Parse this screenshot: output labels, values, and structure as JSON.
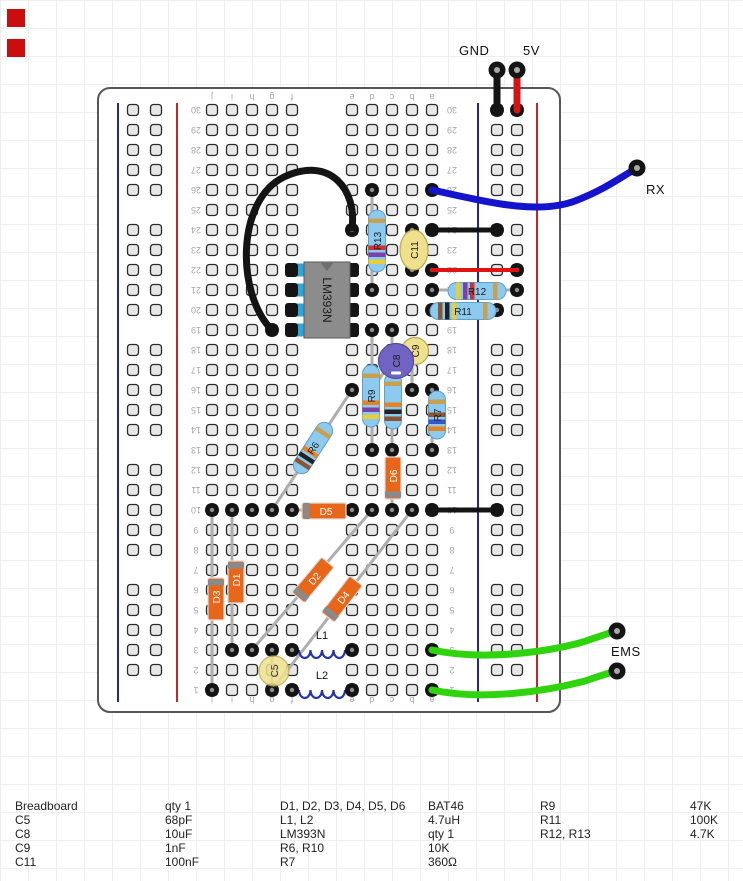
{
  "labels": {
    "gnd": "GND",
    "v5": "5V",
    "rx": "RX",
    "ems": "EMS"
  },
  "markers": [
    {
      "x": 7,
      "y": 9
    },
    {
      "x": 7,
      "y": 39
    }
  ],
  "palette": {
    "marker_red": "#cc0d0d",
    "black": "#141414",
    "red": "#d41414",
    "red2": "#e01212",
    "blue": "#1414cc",
    "green": "#2fd40f",
    "lead": "#aeaeae",
    "hole_fill": "#e7e7e7",
    "hole_stroke": "#2a2a2a",
    "board_fill": "#ffffff",
    "board_stroke": "#575757",
    "rail_blue": "#2626a0",
    "rail_red": "#c62828",
    "resistor": "#8dcaf0",
    "resistor_stroke": "#5f9fc8",
    "diode": "#e8661a",
    "diode_stroke": "#dcdcdc",
    "diode_band": "#8a8a8a",
    "diode_label": "#ffffff",
    "ic": "#8c8c8c",
    "ic_stroke": "#5a5a5a",
    "ic_notch": "#6e6e6e",
    "pin_cyan": "#2aa8dc",
    "cap_yellow": "#efe08d",
    "cap_yellow_stroke": "#b9a94e",
    "cap_purple": "#6f64c4",
    "cap_purple_stroke": "#564a9e",
    "coil": "#2333aa",
    "num": "#a6a6a6",
    "ring_center": "#8f8f8f",
    "label_dark": "#1c1c1c"
  },
  "board": {
    "x": 98,
    "y": 88,
    "w": 462,
    "h": 624,
    "radius": 12,
    "cols": {
      "j": 212,
      "i": 232,
      "h": 252,
      "g": 272,
      "f": 292,
      "e": 352,
      "d": 372,
      "c": 392,
      "b": 412,
      "a": 432
    },
    "row_base_y": 110,
    "row_pitch": 20,
    "row_count": 30,
    "left_letters": [
      "j",
      "i",
      "h",
      "g",
      "f"
    ],
    "right_letters": [
      "e",
      "d",
      "c",
      "b",
      "a"
    ],
    "num_x": [
      196,
      452
    ],
    "letters_y": [
      97,
      700
    ],
    "rails": {
      "left": {
        "blue_x": 118,
        "red_x": 177,
        "holes_x": [
          133,
          156
        ]
      },
      "right": {
        "blue_x": 478,
        "red_x": 537,
        "holes_x": [
          497,
          517
        ]
      }
    },
    "rail_y0": 110,
    "rail_groups": 5,
    "rail_group_pitch": 120,
    "rail_hole_pitch": 20,
    "rail_line_y": [
      103,
      702
    ]
  },
  "rings_grid": [
    [
      "d",
      26
    ],
    [
      "a",
      26
    ],
    [
      "e",
      24
    ],
    [
      "b",
      24
    ],
    [
      "a",
      24
    ],
    [
      "b",
      22
    ],
    [
      "a",
      22
    ],
    [
      "d",
      21
    ],
    [
      "a",
      21
    ],
    [
      "a",
      20
    ],
    [
      "g",
      19
    ],
    [
      "d",
      19
    ],
    [
      "c",
      19
    ],
    [
      "e",
      16
    ],
    [
      "d",
      16
    ],
    [
      "c",
      16
    ],
    [
      "b",
      16
    ],
    [
      "a",
      16
    ],
    [
      "d",
      13
    ],
    [
      "c",
      13
    ],
    [
      "a",
      13
    ],
    [
      "j",
      10
    ],
    [
      "i",
      10
    ],
    [
      "h",
      10
    ],
    [
      "g",
      10
    ],
    [
      "f",
      10
    ],
    [
      "e",
      10
    ],
    [
      "d",
      10
    ],
    [
      "c",
      10
    ],
    [
      "b",
      10
    ],
    [
      "a",
      10
    ],
    [
      "i",
      3
    ],
    [
      "h",
      3
    ],
    [
      "g",
      3
    ],
    [
      "f",
      3
    ],
    [
      "e",
      3
    ],
    [
      "a",
      3
    ],
    [
      "j",
      1
    ],
    [
      "g",
      1
    ],
    [
      "f",
      1
    ],
    [
      "e",
      1
    ],
    [
      "a",
      1
    ]
  ],
  "rings_abs": [
    [
      497,
      110
    ],
    [
      517,
      110
    ],
    [
      497,
      230
    ],
    [
      517,
      270
    ],
    [
      517,
      290
    ],
    [
      497,
      310
    ],
    [
      497,
      510
    ]
  ],
  "leads": [
    [
      372,
      190,
      372,
      290
    ],
    [
      372,
      330,
      372,
      450
    ],
    [
      392,
      330,
      392,
      450
    ],
    [
      432,
      390,
      432,
      450
    ],
    [
      412,
      230,
      412,
      270
    ],
    [
      412,
      350,
      412,
      390
    ],
    [
      388,
      366,
      372,
      390
    ],
    [
      397,
      368,
      392,
      390
    ],
    [
      272,
      650,
      272,
      690
    ],
    [
      212,
      510,
      212,
      690
    ],
    [
      232,
      510,
      232,
      650
    ],
    [
      392,
      450,
      392,
      510
    ],
    [
      292,
      510,
      352,
      510
    ],
    [
      252,
      650,
      372,
      510
    ],
    [
      272,
      690,
      412,
      510
    ],
    [
      272,
      510,
      352,
      390
    ],
    [
      432,
      290,
      517,
      290
    ],
    [
      432,
      310,
      497,
      310
    ]
  ],
  "band_sets": {
    "4.7K": [
      "#e8cf3a",
      "#7d3fa8",
      "#d03030",
      "#c8a050"
    ],
    "47K": [
      "#e8cf3a",
      "#7d3fa8",
      "#e8821e",
      "#c8a050"
    ],
    "100K": [
      "#8a5632",
      "#222222",
      "#e8cf3a",
      "#c8a050"
    ],
    "10K": [
      "#8a5632",
      "#222222",
      "#e8821e",
      "#c8a050"
    ],
    "360": [
      "#e8821e",
      "#3a55c8",
      "#8a5632",
      "#c8a050"
    ]
  },
  "resistors": [
    {
      "name": "R13",
      "label": "R13",
      "cx": 377,
      "cy": 241,
      "len": 62,
      "angle": -90,
      "bands": "4.7K"
    },
    {
      "name": "R9",
      "label": "R9",
      "cx": 371,
      "cy": 396,
      "len": 62,
      "angle": -90,
      "bands": "47K"
    },
    {
      "name": "R10",
      "label": "",
      "cx": 393,
      "cy": 401,
      "len": 56,
      "angle": -90,
      "bands": "10K"
    },
    {
      "name": "R7",
      "label": "R7",
      "cx": 437,
      "cy": 415,
      "len": 48,
      "angle": -90,
      "bands": "360"
    },
    {
      "name": "R6",
      "label": "R6",
      "cx": 313,
      "cy": 448,
      "len": 58,
      "angle": -57,
      "bands": "10K"
    },
    {
      "name": "R12",
      "label": "R12",
      "cx": 477,
      "cy": 291,
      "len": 58,
      "angle": 0,
      "bands": "4.7K"
    },
    {
      "name": "R11",
      "label": "R11",
      "cx": 463,
      "cy": 311,
      "len": 66,
      "angle": 0,
      "bands": "100K"
    }
  ],
  "diodes": [
    {
      "name": "D5",
      "label": "D5",
      "cx": 324,
      "cy": 511,
      "len": 44,
      "angle": 0,
      "band": "minus"
    },
    {
      "name": "D6",
      "label": "D6",
      "cx": 393,
      "cy": 478,
      "len": 42,
      "angle": -90,
      "band": "minus"
    },
    {
      "name": "D3",
      "label": "D3",
      "cx": 216,
      "cy": 599,
      "len": 42,
      "angle": -90,
      "band": "plus"
    },
    {
      "name": "D1",
      "label": "D1",
      "cx": 236,
      "cy": 582,
      "len": 42,
      "angle": -90,
      "band": "plus"
    },
    {
      "name": "D2",
      "label": "D2",
      "cx": 313,
      "cy": 580,
      "len": 46,
      "angle": -50,
      "band": "minus"
    },
    {
      "name": "D4",
      "label": "D4",
      "cx": 342,
      "cy": 599,
      "len": 46,
      "angle": -52,
      "band": "minus"
    }
  ],
  "capacitors": [
    {
      "name": "C9",
      "label": "C9",
      "cx": 415,
      "cy": 351,
      "rx": 13.5,
      "ry": 13.5,
      "style": "yellow"
    },
    {
      "name": "C8",
      "label": "C8",
      "cx": 396,
      "cy": 361,
      "rx": 17.5,
      "ry": 17.5,
      "style": "purple",
      "polarity": true
    },
    {
      "name": "C11",
      "label": "C11",
      "cx": 414,
      "cy": 250,
      "rx": 14,
      "ry": 20,
      "style": "yellow"
    },
    {
      "name": "C5",
      "label": "C5",
      "cx": 274,
      "cy": 671,
      "rx": 15,
      "ry": 15,
      "style": "yellow",
      "opacity": 0.85
    }
  ],
  "inductors": [
    {
      "name": "L1",
      "label": "L1",
      "x1": 292,
      "x2": 352,
      "y": 650,
      "lx": 322,
      "ly": 639
    },
    {
      "name": "L2",
      "label": "L2",
      "x1": 292,
      "x2": 352,
      "y": 690,
      "lx": 322,
      "ly": 679
    }
  ],
  "ic": {
    "name": "IC1",
    "label": "LM393N",
    "x": 304,
    "y": 262,
    "w": 46,
    "h": 76,
    "pin_rows": [
      19,
      20,
      21,
      22
    ],
    "left_x": 292,
    "right_x": 352
  },
  "wires": [
    {
      "name": "gnd-wire",
      "color": "black",
      "width": 7,
      "path": "M497,70 L497,110"
    },
    {
      "name": "5v-wire",
      "color": "red",
      "width": 7,
      "path": "M517,70 L517,110"
    },
    {
      "name": "rx-wire",
      "color": "blue",
      "width": 7,
      "path": "M432,190 C488,202 537,215 575,201 C606,189 621,177 637,168"
    },
    {
      "name": "row24-jumper",
      "color": "black",
      "width": 5,
      "path": "M432,230 L497,230"
    },
    {
      "name": "row22-jumper",
      "color": "red2",
      "width": 4,
      "path": "M432,270 L517,270"
    },
    {
      "name": "row10-jumper",
      "color": "black",
      "width": 5,
      "path": "M432,510 L497,510"
    },
    {
      "name": "ems-wire-1",
      "color": "green",
      "width": 7,
      "path": "M432,650 C483,661 547,652 583,642 C603,635 612,632 617,631"
    },
    {
      "name": "ems-wire-2",
      "color": "green",
      "width": 7,
      "path": "M432,690 C483,701 547,691 585,681 C605,674 613,672 617,671"
    },
    {
      "name": "ic-jumper",
      "color": "black",
      "width": 7,
      "path": "M272,330 C236,294 236,200 284,177 C331,155 357,191 352,228"
    }
  ],
  "pins": [
    {
      "name": "gnd-pin",
      "x": 497,
      "y": 70
    },
    {
      "name": "5v-pin",
      "x": 517,
      "y": 70
    },
    {
      "name": "rx-pin",
      "x": 637,
      "y": 168
    },
    {
      "name": "ems-pin-1",
      "x": 617,
      "y": 631
    },
    {
      "name": "ems-pin-2",
      "x": 617,
      "y": 671
    }
  ],
  "parts_table": {
    "x_cols": [
      15,
      165,
      280,
      428,
      540,
      690
    ],
    "y_start": 799,
    "row_h": 14,
    "rows": [
      [
        "Breadboard",
        "qty 1",
        "D1, D2, D3, D4, D5, D6",
        "BAT46",
        "R9",
        "47K"
      ],
      [
        "C5",
        "68pF",
        "L1, L2",
        "4.7uH",
        "R11",
        "100K"
      ],
      [
        "C8",
        "10uF",
        "LM393N",
        "qty 1",
        "R12, R13",
        "4.7K"
      ],
      [
        "C9",
        "1nF",
        "R6, R10",
        "10K",
        "",
        ""
      ],
      [
        "C11",
        "100nF",
        "R7",
        "360Ω",
        "",
        ""
      ]
    ]
  }
}
